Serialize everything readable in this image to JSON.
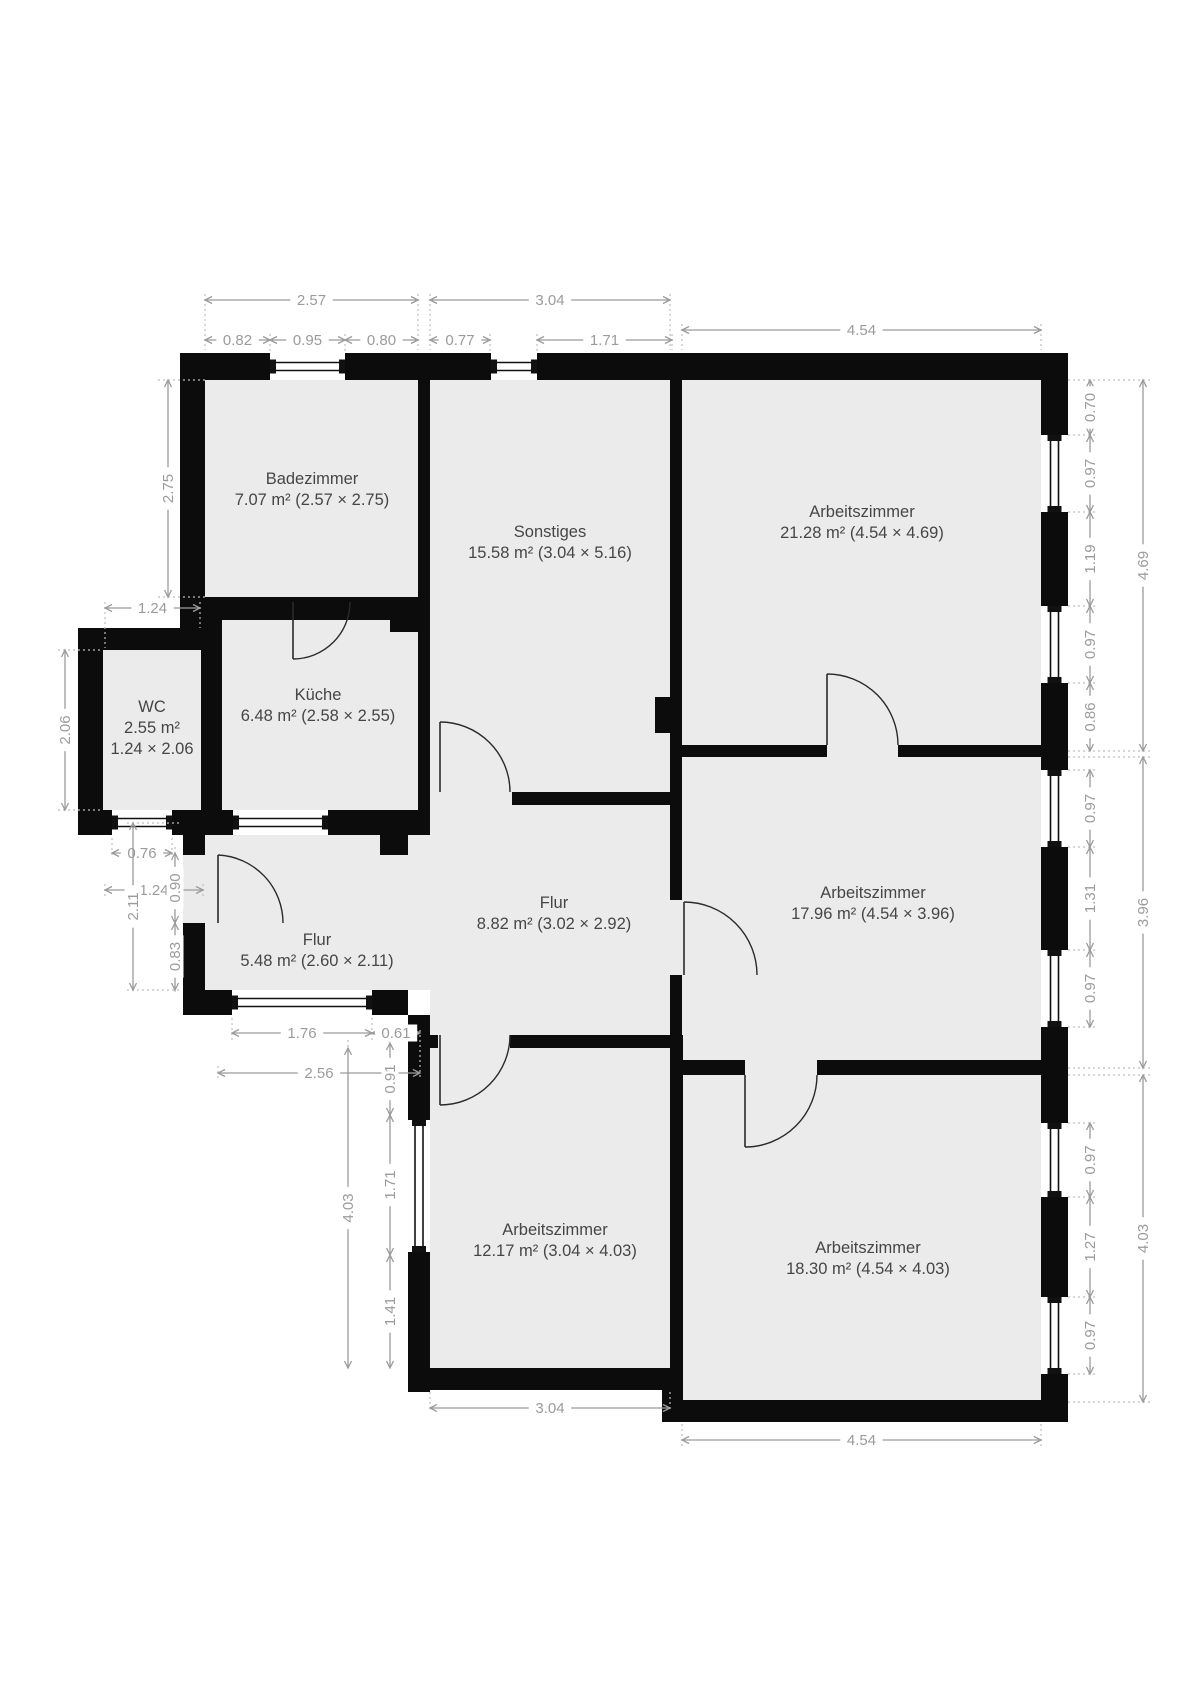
{
  "plan": {
    "colors": {
      "background": "#ffffff",
      "floor": "#ebebeb",
      "wall": "#0c0c0c",
      "dimension": "#9b9b9b",
      "room_text": "#464646",
      "door": "#2a2a2a",
      "guide": "#bdbdbd"
    },
    "rooms": [
      {
        "id": "badezimmer",
        "lines": [
          "Badezimmer",
          "7.07 m² (2.57 × 2.75)"
        ],
        "label_x": 312,
        "label_y": 484
      },
      {
        "id": "sonstiges",
        "lines": [
          "Sonstiges",
          "15.58 m² (3.04 × 5.16)"
        ],
        "label_x": 550,
        "label_y": 537
      },
      {
        "id": "arbeitszimmer-oben",
        "lines": [
          "Arbeitszimmer",
          "21.28 m² (4.54 × 4.69)"
        ],
        "label_x": 862,
        "label_y": 517
      },
      {
        "id": "wc",
        "lines": [
          "WC",
          "2.55 m²",
          "1.24 × 2.06"
        ],
        "label_x": 152,
        "label_y": 712
      },
      {
        "id": "kueche",
        "lines": [
          "Küche",
          "6.48 m² (2.58 × 2.55)"
        ],
        "label_x": 318,
        "label_y": 700
      },
      {
        "id": "flur-gross",
        "lines": [
          "Flur",
          "8.82 m² (3.02 × 2.92)"
        ],
        "label_x": 554,
        "label_y": 908
      },
      {
        "id": "arbeitszimmer-mitte",
        "lines": [
          "Arbeitszimmer",
          "17.96 m² (4.54 × 3.96)"
        ],
        "label_x": 873,
        "label_y": 898
      },
      {
        "id": "flur-klein",
        "lines": [
          "Flur",
          "5.48 m² (2.60 × 2.11)"
        ],
        "label_x": 317,
        "label_y": 945
      },
      {
        "id": "arbeitszimmer-unten-links",
        "lines": [
          "Arbeitszimmer",
          "12.17 m² (3.04 × 4.03)"
        ],
        "label_x": 555,
        "label_y": 1235
      },
      {
        "id": "arbeitszimmer-unten-rechts",
        "lines": [
          "Arbeitszimmer",
          "18.30 m² (4.54 × 4.03)"
        ],
        "label_x": 868,
        "label_y": 1253
      }
    ],
    "dimensions": [
      {
        "value": "2.57",
        "orient": "h",
        "from": 205,
        "to": 418,
        "at": 300
      },
      {
        "value": "3.04",
        "orient": "h",
        "from": 430,
        "to": 670,
        "at": 300
      },
      {
        "value": "4.54",
        "orient": "h",
        "from": 682,
        "to": 1041,
        "at": 330
      },
      {
        "value": "0.82",
        "orient": "h",
        "from": 205,
        "to": 270,
        "at": 340
      },
      {
        "value": "0.95",
        "orient": "h",
        "from": 270,
        "to": 345,
        "at": 340
      },
      {
        "value": "0.80",
        "orient": "h",
        "from": 345,
        "to": 418,
        "at": 340
      },
      {
        "value": "0.77",
        "orient": "h",
        "from": 430,
        "to": 490,
        "at": 340
      },
      {
        "value": "1.71",
        "orient": "h",
        "from": 537,
        "to": 672,
        "at": 340
      },
      {
        "value": "0.70",
        "orient": "v",
        "from": 380,
        "to": 435,
        "at": 1090
      },
      {
        "value": "0.97",
        "orient": "v",
        "from": 435,
        "to": 512,
        "at": 1090
      },
      {
        "value": "1.19",
        "orient": "v",
        "from": 512,
        "to": 606,
        "at": 1090
      },
      {
        "value": "0.97",
        "orient": "v",
        "from": 606,
        "to": 683,
        "at": 1090
      },
      {
        "value": "0.86",
        "orient": "v",
        "from": 683,
        "to": 751,
        "at": 1090
      },
      {
        "value": "4.69",
        "orient": "v",
        "from": 380,
        "to": 751,
        "at": 1143
      },
      {
        "value": "0.97",
        "orient": "v",
        "from": 770,
        "to": 847,
        "at": 1090
      },
      {
        "value": "1.31",
        "orient": "v",
        "from": 847,
        "to": 950,
        "at": 1090
      },
      {
        "value": "0.97",
        "orient": "v",
        "from": 950,
        "to": 1027,
        "at": 1090
      },
      {
        "value": "3.96",
        "orient": "v",
        "from": 757,
        "to": 1068,
        "at": 1143
      },
      {
        "value": "0.97",
        "orient": "v",
        "from": 1123,
        "to": 1197,
        "at": 1090
      },
      {
        "value": "1.27",
        "orient": "v",
        "from": 1197,
        "to": 1297,
        "at": 1090
      },
      {
        "value": "0.97",
        "orient": "v",
        "from": 1297,
        "to": 1374,
        "at": 1090
      },
      {
        "value": "4.03",
        "orient": "v",
        "from": 1075,
        "to": 1402,
        "at": 1143
      },
      {
        "value": "2.75",
        "orient": "v",
        "from": 380,
        "to": 597,
        "at": 168
      },
      {
        "value": "1.24",
        "orient": "h",
        "from": 105,
        "to": 200,
        "at": 608
      },
      {
        "value": "2.06",
        "orient": "v",
        "from": 650,
        "to": 810,
        "at": 65
      },
      {
        "value": "0.76",
        "orient": "h",
        "from": 112,
        "to": 172,
        "at": 853
      },
      {
        "value": "1.24",
        "orient": "h",
        "from": 105,
        "to": 203,
        "at": 890
      },
      {
        "value": "2.11",
        "orient": "v",
        "from": 823,
        "to": 990,
        "at": 133
      },
      {
        "value": "0.90",
        "orient": "v",
        "from": 853,
        "to": 923,
        "at": 175
      },
      {
        "value": "0.83",
        "orient": "v",
        "from": 923,
        "to": 990,
        "at": 175
      },
      {
        "value": "1.76",
        "orient": "h",
        "from": 232,
        "to": 372,
        "at": 1033
      },
      {
        "value": "0.61",
        "orient": "h",
        "from": 372,
        "to": 420,
        "at": 1033
      },
      {
        "value": "2.56",
        "orient": "h",
        "from": 218,
        "to": 420,
        "at": 1073
      },
      {
        "value": "0.91",
        "orient": "v",
        "from": 1043,
        "to": 1115,
        "at": 390
      },
      {
        "value": "1.71",
        "orient": "v",
        "from": 1115,
        "to": 1255,
        "at": 390
      },
      {
        "value": "1.41",
        "orient": "v",
        "from": 1255,
        "to": 1368,
        "at": 390
      },
      {
        "value": "4.03",
        "orient": "v",
        "from": 1048,
        "to": 1368,
        "at": 348
      },
      {
        "value": "3.04",
        "orient": "h",
        "from": 430,
        "to": 670,
        "at": 1408
      },
      {
        "value": "4.54",
        "orient": "h",
        "from": 682,
        "to": 1041,
        "at": 1440
      }
    ]
  }
}
